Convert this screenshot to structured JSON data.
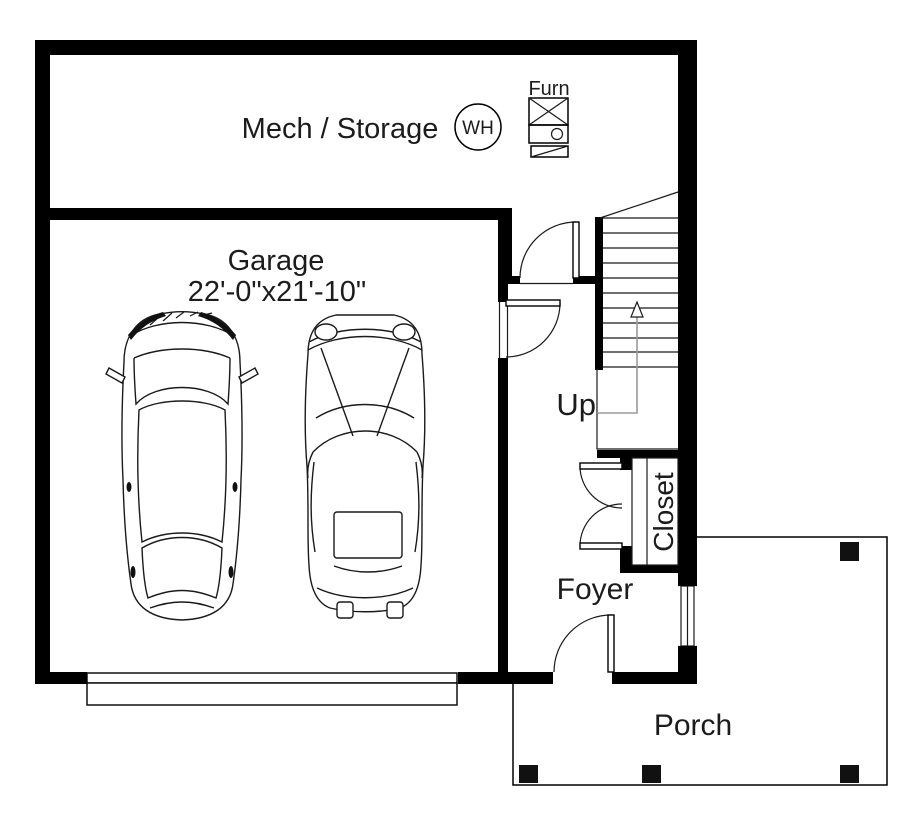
{
  "plan": {
    "colors": {
      "background": "#ffffff",
      "wall": "#000000",
      "text": "#1c1c1c",
      "stair_arrow": "#9a9a9a"
    },
    "rooms": {
      "mech_storage": {
        "label": "Mech / Storage"
      },
      "garage": {
        "label": "Garage",
        "dimension": "22'-0\"x21'-10\""
      },
      "closet": {
        "label": "Closet"
      },
      "foyer": {
        "label": "Foyer"
      },
      "porch": {
        "label": "Porch"
      }
    },
    "stairs": {
      "direction_label": "Up"
    },
    "equipment": {
      "water_heater": {
        "label": "WH"
      },
      "furnace": {
        "label": "Furn"
      }
    }
  }
}
